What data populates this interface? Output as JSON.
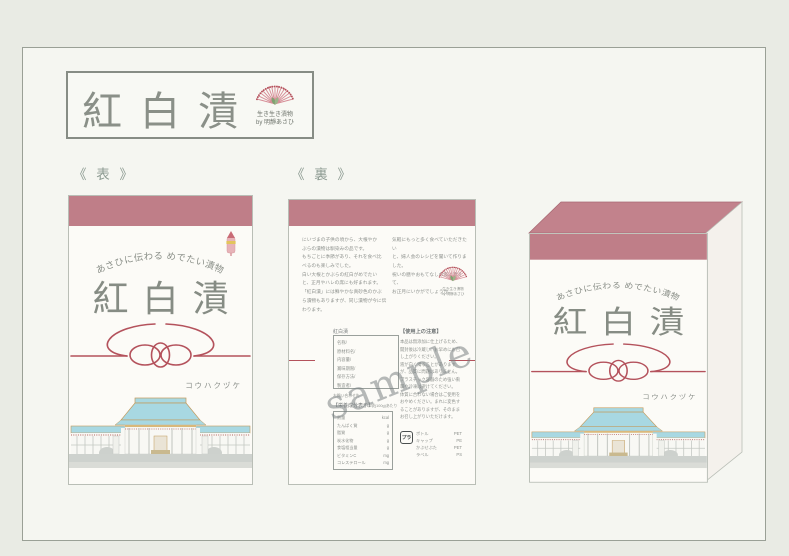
{
  "logo": {
    "title": "紅白漬",
    "fan_caption_line1": "生き生き漬物",
    "fan_caption_line2": "by 明靜あさひ"
  },
  "sections": {
    "front_label": "《 表 》",
    "back_label": "《 裏 》"
  },
  "package_front": {
    "arc_text": "あさひに伝わる めでたい漬物",
    "title": "紅白漬",
    "katakana": "コウハクヅケ"
  },
  "package_back": {
    "intro_left_lines": [
      "にいづまの子供の頃から、大根やか",
      "ぶらの漬物は馴染みの品です。",
      "もちごとに季節があり、それを食べ比",
      "べるのも楽しみでした。",
      "白い大根とかぶらの紅白がめでたい",
      "と、正月やハレの席にも好まれます。",
      "「紅白漬」には鮮やかな真砂色のかぶ",
      "ら漬物もありますが、同じ漬物が今に伝わります。"
    ],
    "intro_right_lines": [
      "気軽にもっと多く食べていただきたい",
      "と、婦人会のレシピを聞いて作りました。",
      "祝いの膳やおもてなしの席に添えて、",
      "お正月にいかがでしょうか。"
    ],
    "fan_caption_line1": "生き生き漬物",
    "fan_caption_line2": "by 明靜あさひ",
    "label_box": {
      "title": "紅白漬",
      "rows": [
        "名称/",
        "原材料名/",
        "内容量/",
        "賞味期限/",
        "保存方法/",
        "製造者/"
      ],
      "note": "お問い合わせ先"
    },
    "nutrition": {
      "heading": "【栄養成分表示】",
      "subheading": "1袋(100g)あたり",
      "rows": [
        [
          "熱量",
          "kcal"
        ],
        [
          "たんぱく質",
          "g"
        ],
        [
          "脂質",
          "g"
        ],
        [
          "炭水化物",
          "g"
        ],
        [
          "食塩相当量",
          "g"
        ],
        [
          "ビタミンC",
          "mg"
        ],
        [
          "コレステロール",
          "mg"
        ]
      ]
    },
    "caution": {
      "heading": "【使用上の注意】",
      "lines": [
        "本品は無添加に仕上げるため、",
        "開封後は冷蔵し、お早めにお召",
        "し上がりください。",
        "液が白く濁ることがあります",
        "が、品質に問題はありません。",
        "プラスチック容器のため強い衝",
        "撃や冷凍は避けてください。",
        "体質に合わない場合はご使用を",
        "おやめください。まれに変色す",
        "ることがありますが、そのまま",
        "お召し上がりいただけます。"
      ]
    },
    "recycle": {
      "mark": "プラ",
      "rows": [
        [
          "ボトル",
          "PET"
        ],
        [
          "キャップ",
          "PE"
        ],
        [
          "かぶせぶた",
          "PET"
        ],
        [
          "ラベル",
          "PS"
        ]
      ]
    },
    "watermark": "sample"
  },
  "icons": {
    "fan": "folding-fan with sprout mark",
    "charm": "omamori amulet charm",
    "recycle_mark": "plastic recycling mark"
  },
  "colors": {
    "band_pink": "#bf7e88",
    "cord_red": "#b4525c",
    "roof_blue": "#a8d8e2",
    "title_gray": "#868c84",
    "paper": "#f5f6f1"
  }
}
